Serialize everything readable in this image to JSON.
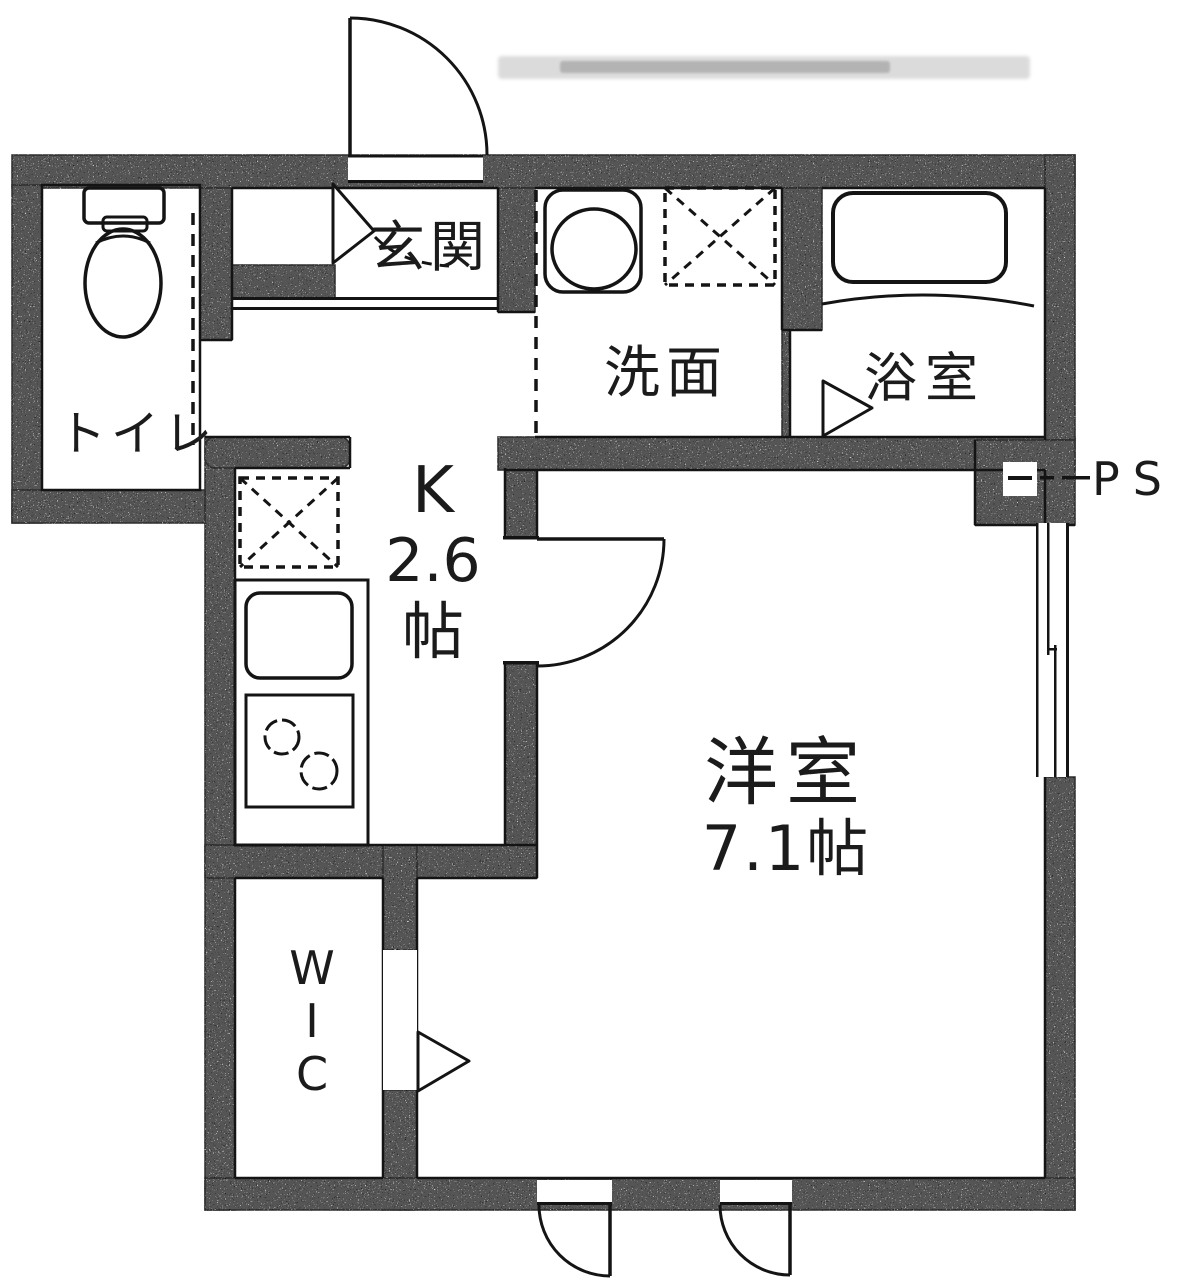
{
  "plan": {
    "rooms": {
      "entrance": {
        "label": "玄関"
      },
      "toilet": {
        "label": "トイレ"
      },
      "washroom": {
        "label": "洗面"
      },
      "bathroom": {
        "label": "浴室"
      },
      "kitchen": {
        "type_label": "K",
        "size_value": "2.6",
        "size_unit": "帖"
      },
      "western_room": {
        "label": "洋室",
        "size": "7.1帖"
      },
      "walk_in_closet": {
        "letters": [
          "W",
          "I",
          "C"
        ]
      },
      "pipe_space": {
        "label": "PS"
      }
    },
    "colors": {
      "wall": "#545454",
      "line": "#141414",
      "background": "#ffffff"
    }
  }
}
